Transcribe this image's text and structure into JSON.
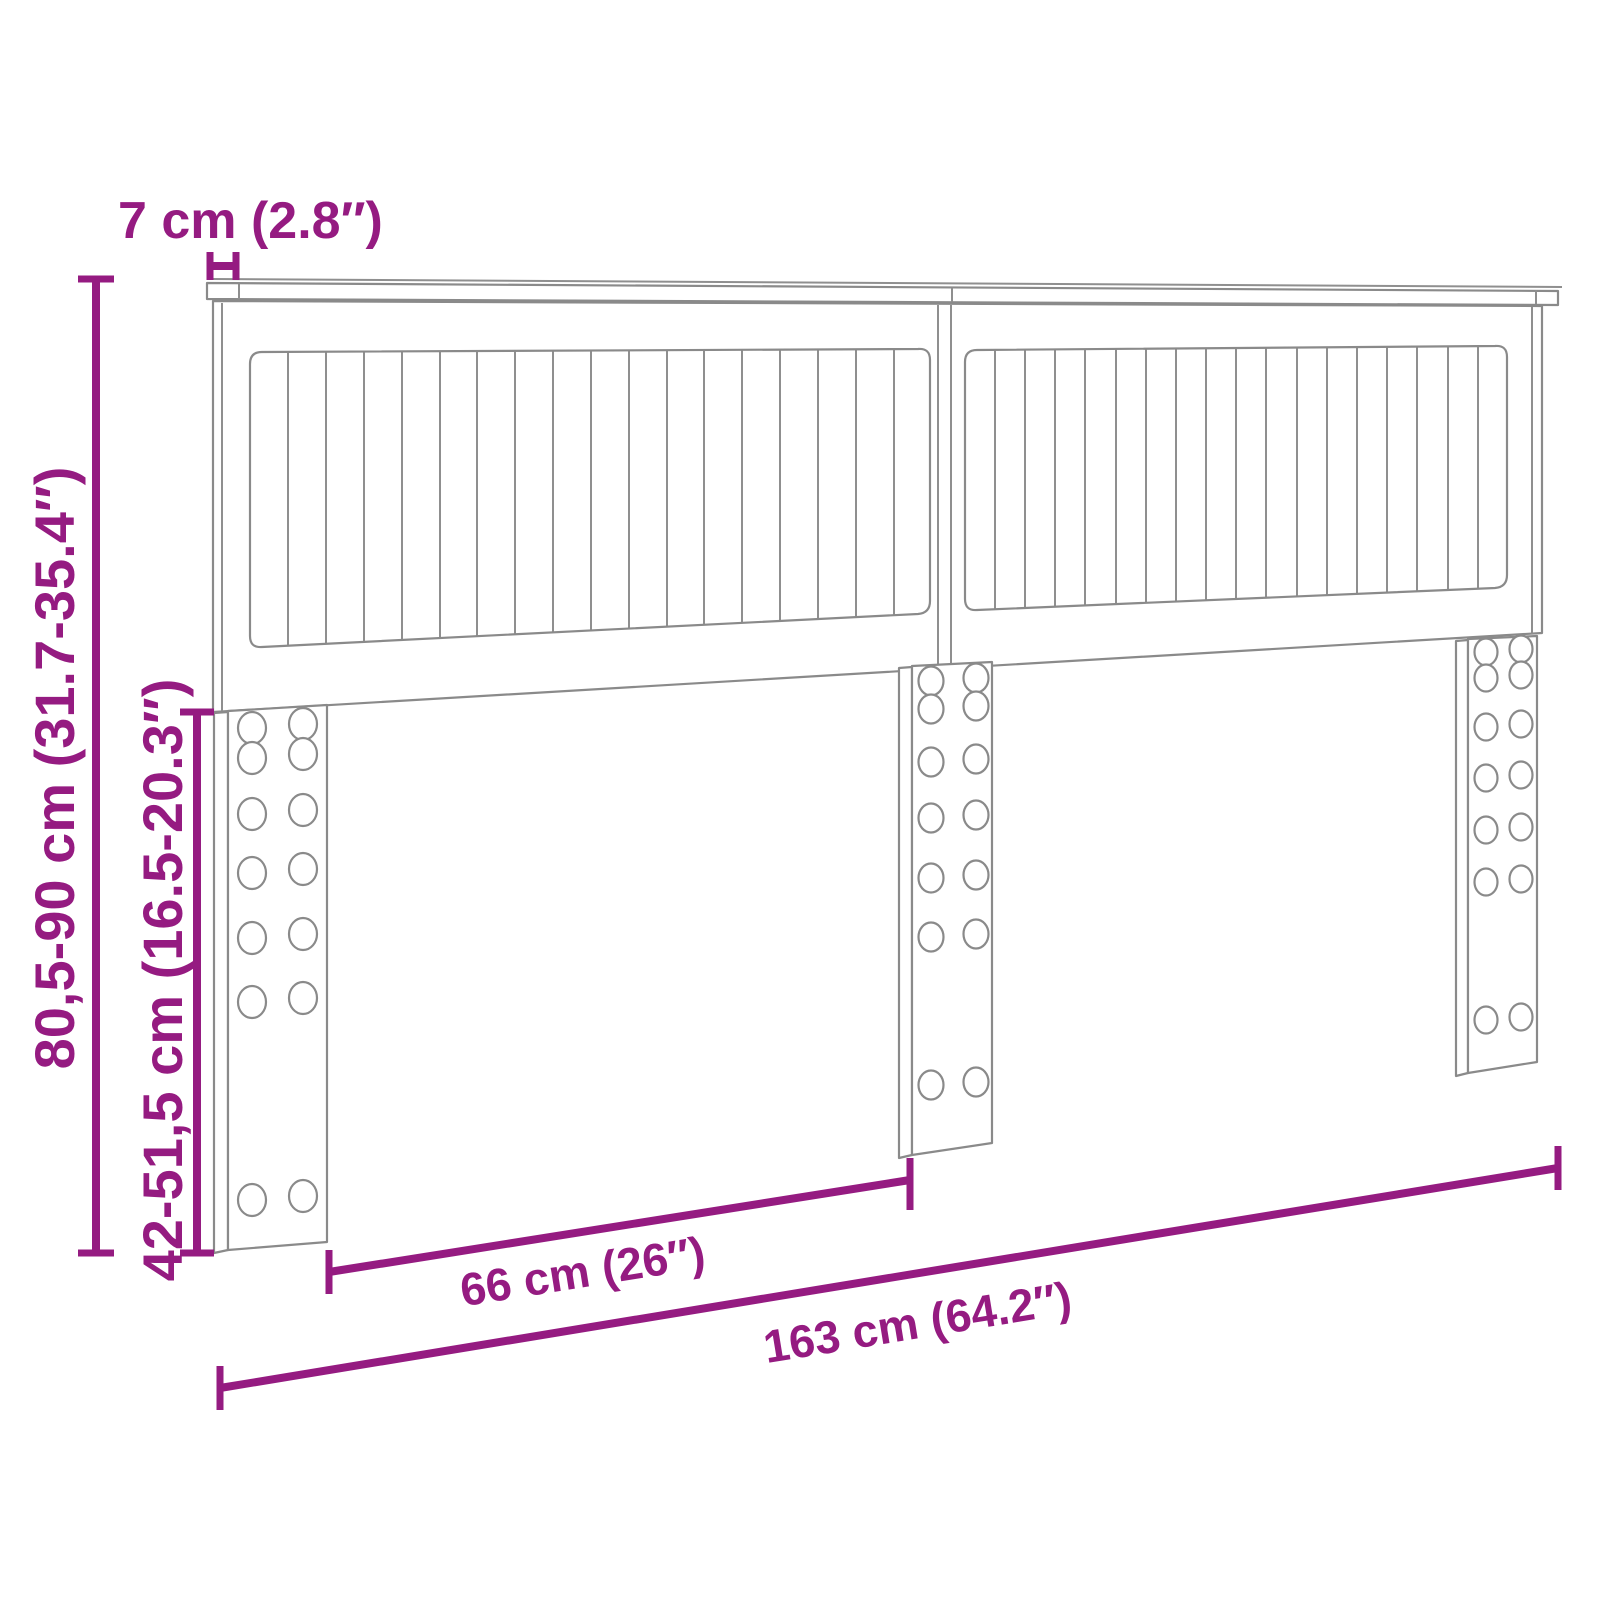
{
  "diagram": {
    "kind": "furniture-dimension-diagram",
    "subject": "headboard-with-slats-and-three-legs",
    "background_color": "#ffffff",
    "outline_color": "#8a8a8a",
    "accent_color": "#951b81",
    "labels": {
      "top_thickness": "7 cm (2.8″)",
      "total_height": "80,5-90 cm (31.7-35.4″)",
      "leg_height": "42-51,5 cm (16.5-20.3″)",
      "leg_gap": "66 cm (26″)",
      "total_width": "163 cm (64.2″)"
    }
  }
}
